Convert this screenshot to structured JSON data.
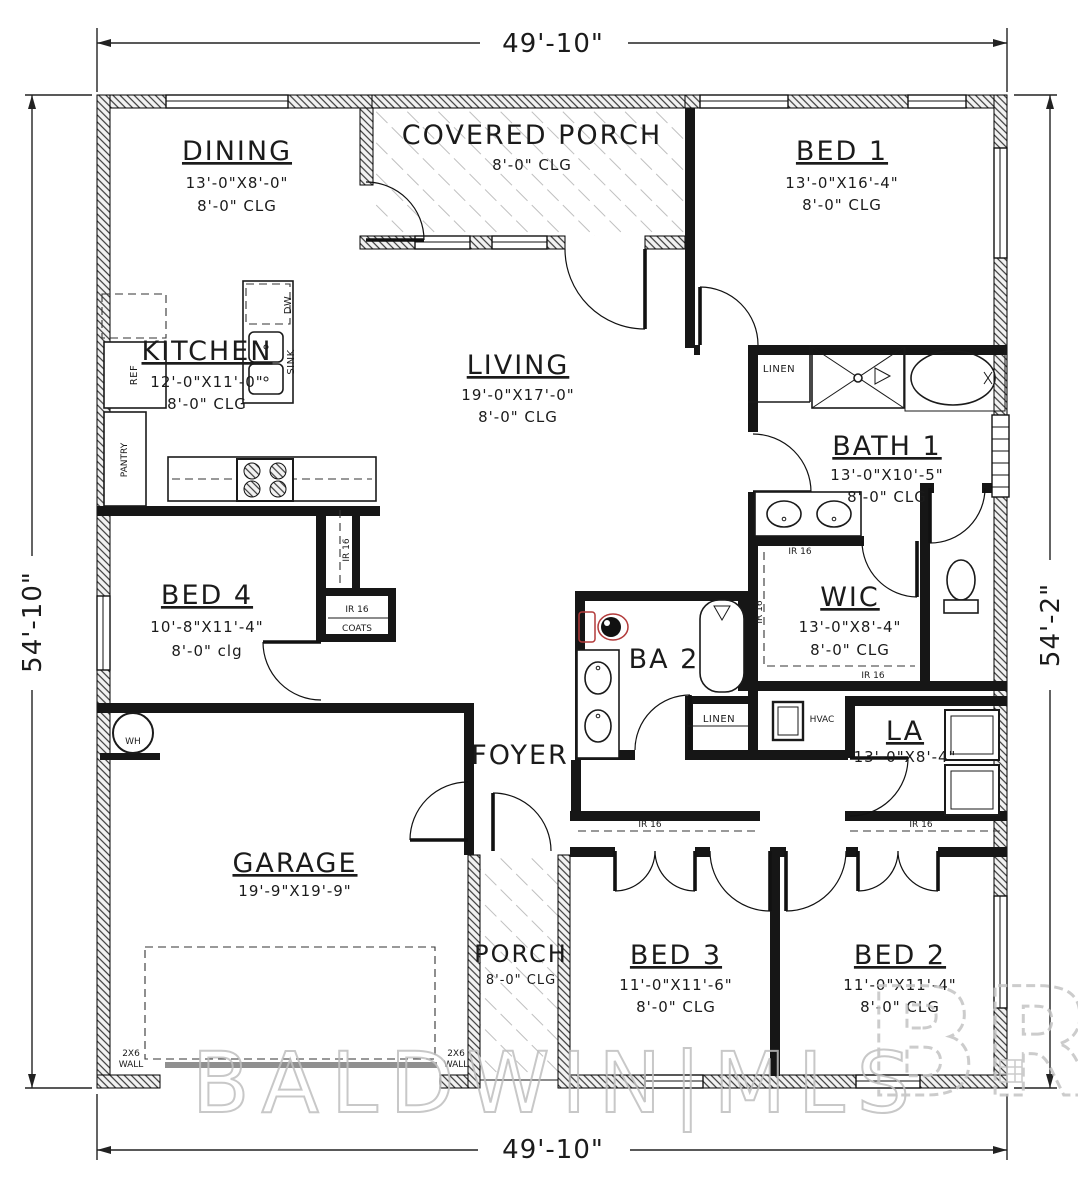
{
  "dims": {
    "top": "49'-10\"",
    "bottom": "49'-10\"",
    "left": "54'-10\"",
    "right": "54'-2\""
  },
  "rooms": {
    "dining": {
      "name": "DINING",
      "size": "13'-0\"X8'-0\"",
      "clg": "8'-0\" CLG"
    },
    "covered_porch": {
      "name": "COVERED PORCH",
      "clg": "8'-0\" CLG"
    },
    "bed1": {
      "name": "BED 1",
      "size": "13'-0\"X16'-4\"",
      "clg": "8'-0\" CLG"
    },
    "kitchen": {
      "name": "KITCHEN",
      "size": "12'-0\"X11'-0\"",
      "clg": "8'-0\" CLG"
    },
    "living": {
      "name": "LIVING",
      "size": "19'-0\"X17'-0\"",
      "clg": "8'-0\" CLG"
    },
    "bath1": {
      "name": "BATH 1",
      "size": "13'-0\"X10'-5\"",
      "clg": "8'-0\" CLG"
    },
    "bed4": {
      "name": "BED 4",
      "size": "10'-8\"X11'-4\"",
      "clg": "8'-0\" clg"
    },
    "wic": {
      "name": "WIC",
      "size": "13'-0\"X8'-4\"",
      "clg": "8'-0\" CLG"
    },
    "ba2": {
      "name": "BA 2"
    },
    "foyer": {
      "name": "FOYER"
    },
    "la": {
      "name": "LA",
      "size": "13'-0\"X8'-4\""
    },
    "garage": {
      "name": "GARAGE",
      "size": "19'-9\"X19'-9\""
    },
    "porch": {
      "name": "PORCH",
      "clg": "8'-0\" CLG"
    },
    "bed3": {
      "name": "BED 3",
      "size": "11'-0\"X11'-6\"",
      "clg": "8'-0\" CLG"
    },
    "bed2": {
      "name": "BED 2",
      "size": "11'-0\"X11'-4\"",
      "clg": "8'-0\" CLG"
    }
  },
  "fixtures": {
    "ref": "REF",
    "dw": "DW",
    "sink": "SINK",
    "pantry": "PANTRY",
    "linen": "LINEN",
    "wh": "WH",
    "hvac": "HVAC",
    "ir16": "IR 16",
    "coats": "COATS",
    "wall_note_l1": "2X6",
    "wall_note_l2": "WALL"
  },
  "watermark": {
    "logo": "BR",
    "text": "BALDWIN|MLS"
  },
  "colors": {
    "wall": "#161616",
    "toilet_accent": "#b23a3a",
    "watermark": "#bfbfbf"
  }
}
